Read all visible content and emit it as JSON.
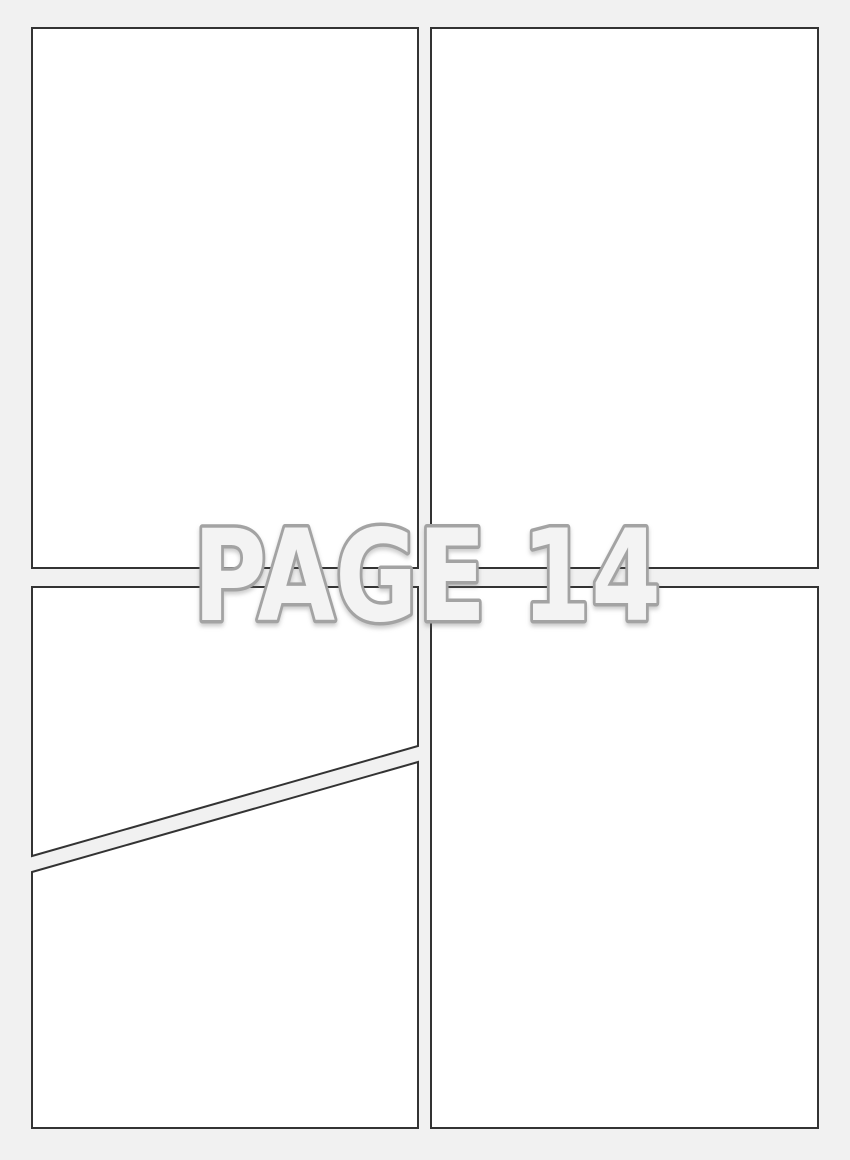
{
  "watermark": {
    "label": "PAGE 14"
  },
  "colors": {
    "page-bg": "#f1f1f1",
    "panel-fill": "#ffffff",
    "panel-border": "#333333",
    "watermark-fill": "#f3f3f3",
    "watermark-outline": "#a3a3a3"
  },
  "panels": [
    {
      "name": "top-left"
    },
    {
      "name": "top-right"
    },
    {
      "name": "bottom-left-upper-diagonal"
    },
    {
      "name": "bottom-left-lower-diagonal"
    },
    {
      "name": "bottom-right"
    }
  ]
}
